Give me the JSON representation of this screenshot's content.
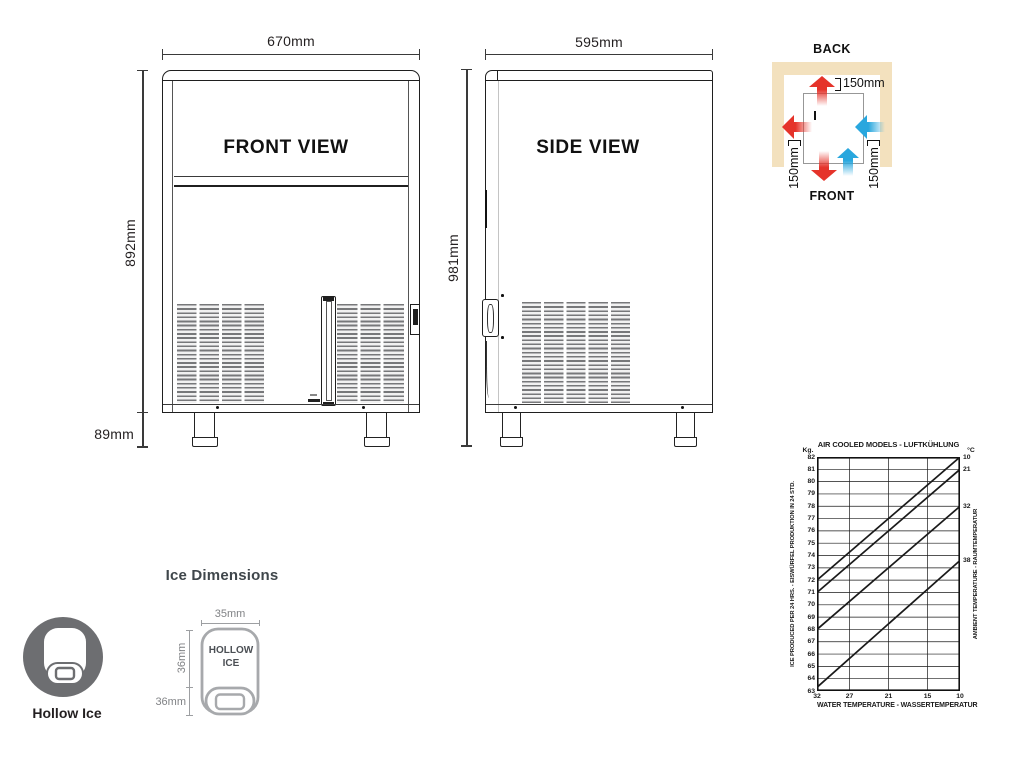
{
  "front_view": {
    "label": "FRONT VIEW",
    "width_dim": "670mm",
    "height_dim": "892mm",
    "leg_dim": "89mm"
  },
  "side_view": {
    "label": "SIDE VIEW",
    "width_dim": "595mm",
    "height_dim": "981mm"
  },
  "clearance": {
    "back_label": "BACK",
    "front_label": "FRONT",
    "top_dim": "150mm",
    "left_dim": "150mm",
    "right_dim": "150mm",
    "wall_color": "#f3e1be",
    "hot_air_color": "#e5332a",
    "cool_air_color": "#29a7de"
  },
  "ice": {
    "section_title": "Ice Dimensions",
    "type_label": "Hollow Ice",
    "cube_label": "HOLLOW ICE",
    "width_dim": "35mm",
    "height_dim": "36mm",
    "depth_dim": "36mm"
  },
  "chart_data": {
    "type": "line",
    "title": "AIR COOLED MODELS - LUFTKÜHLUNG",
    "xlabel": "WATER TEMPERATURE - WASSERTEMPERATUR",
    "ylabel_left": "ICE PRODUCED PER 24 HRS. - EISWÜRFEL PRODUKTION IN 24 STD.",
    "ylabel_right": "AMBIENT TEMPERATURE - RAUMTEMPERATUR",
    "y_unit": "Kg.",
    "right_unit": "°C",
    "x_ticks": [
      32,
      27,
      21,
      15,
      10
    ],
    "y_ticks": [
      82,
      81,
      80,
      79,
      78,
      77,
      76,
      75,
      74,
      73,
      72,
      71,
      70,
      69,
      68,
      67,
      66,
      65,
      64,
      63
    ],
    "x_range": [
      32,
      10
    ],
    "y_range": [
      63,
      82
    ],
    "grid": true,
    "legend_position": "right-line-labels",
    "series": [
      {
        "name": "10",
        "points": [
          [
            32,
            72.0
          ],
          [
            10,
            82.0
          ]
        ]
      },
      {
        "name": "21",
        "points": [
          [
            32,
            71.0
          ],
          [
            10,
            81.0
          ]
        ]
      },
      {
        "name": "32",
        "points": [
          [
            32,
            68.0
          ],
          [
            10,
            78.0
          ]
        ]
      },
      {
        "name": "38",
        "points": [
          [
            32,
            63.3
          ],
          [
            10,
            73.6
          ]
        ]
      }
    ]
  }
}
